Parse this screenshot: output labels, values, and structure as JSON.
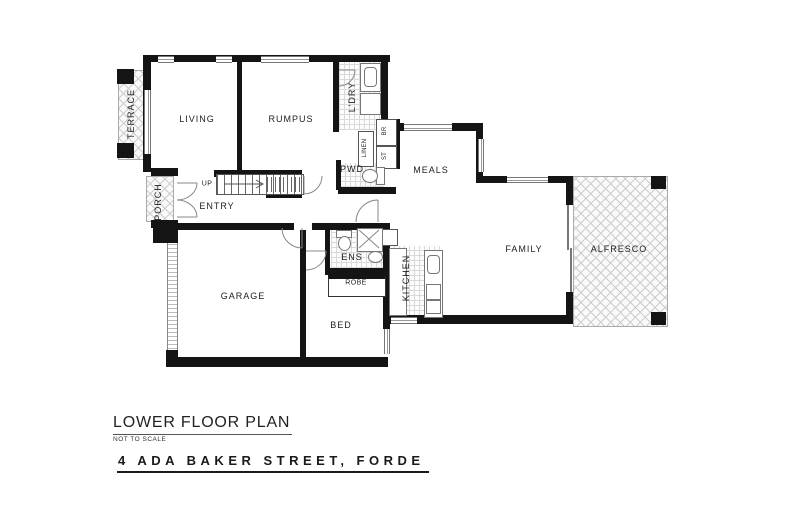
{
  "title_block": {
    "title": "LOWER FLOOR PLAN",
    "scale_note": "NOT TO SCALE",
    "address": "4 ADA BAKER STREET, FORDE"
  },
  "rooms": {
    "terrace": "TERRACE",
    "living": "LIVING",
    "rumpus": "RUMPUS",
    "laundry": "L'DRY",
    "broom": "BR",
    "linen": "LINEN",
    "store": "ST",
    "powder": "PWD",
    "meals": "MEALS",
    "porch": "PORCH",
    "entry": "ENTRY",
    "stairs_direction": "UP",
    "garage": "GARAGE",
    "ensuite": "ENS",
    "robe": "ROBE",
    "kitchen": "KITCHEN",
    "bed": "BED",
    "family": "FAMILY",
    "alfresco": "ALFRESCO"
  },
  "colors": {
    "wall": "#141414",
    "thin_line": "#777777",
    "hatch_line": "#cccccc",
    "text": "#222222"
  }
}
